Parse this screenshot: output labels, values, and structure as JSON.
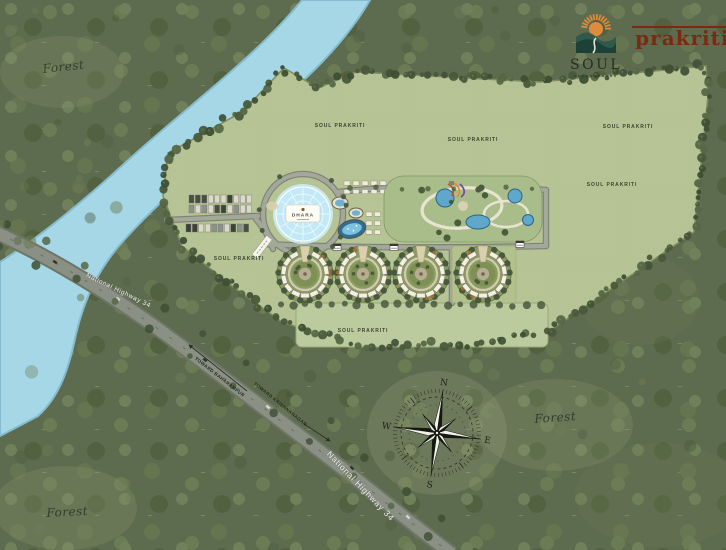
{
  "brand": {
    "soul": "SOUL",
    "prakriti": "prakriti"
  },
  "labels": {
    "forest_top_left": "Forest",
    "forest_mid_right": "Forest",
    "forest_bottom_left": "Forest",
    "highway_upper": "National Highway 34",
    "highway_lower": "National Highway 34",
    "direction_upper": "TOWARD BAHARAMPUR",
    "direction_lower": "TOWARD KRISHNANAGAR",
    "dome": "DHARA",
    "areas": [
      "SOUL PRAKRITI",
      "SOUL PRAKRITI",
      "SOUL PRAKRITI",
      "SOUL PRAKRITI",
      "SOUL PRAKRITI",
      "SOUL PRAKRITI"
    ]
  },
  "compass": {
    "north": "N",
    "east": "E",
    "south": "S",
    "west": "W"
  },
  "colors": {
    "accent_orange": "#e08a3c",
    "brand_green": "#2f5a4a",
    "prakriti_red": "#7a2a10",
    "water": "#a6d7e6",
    "site_green": "#b6c395"
  }
}
